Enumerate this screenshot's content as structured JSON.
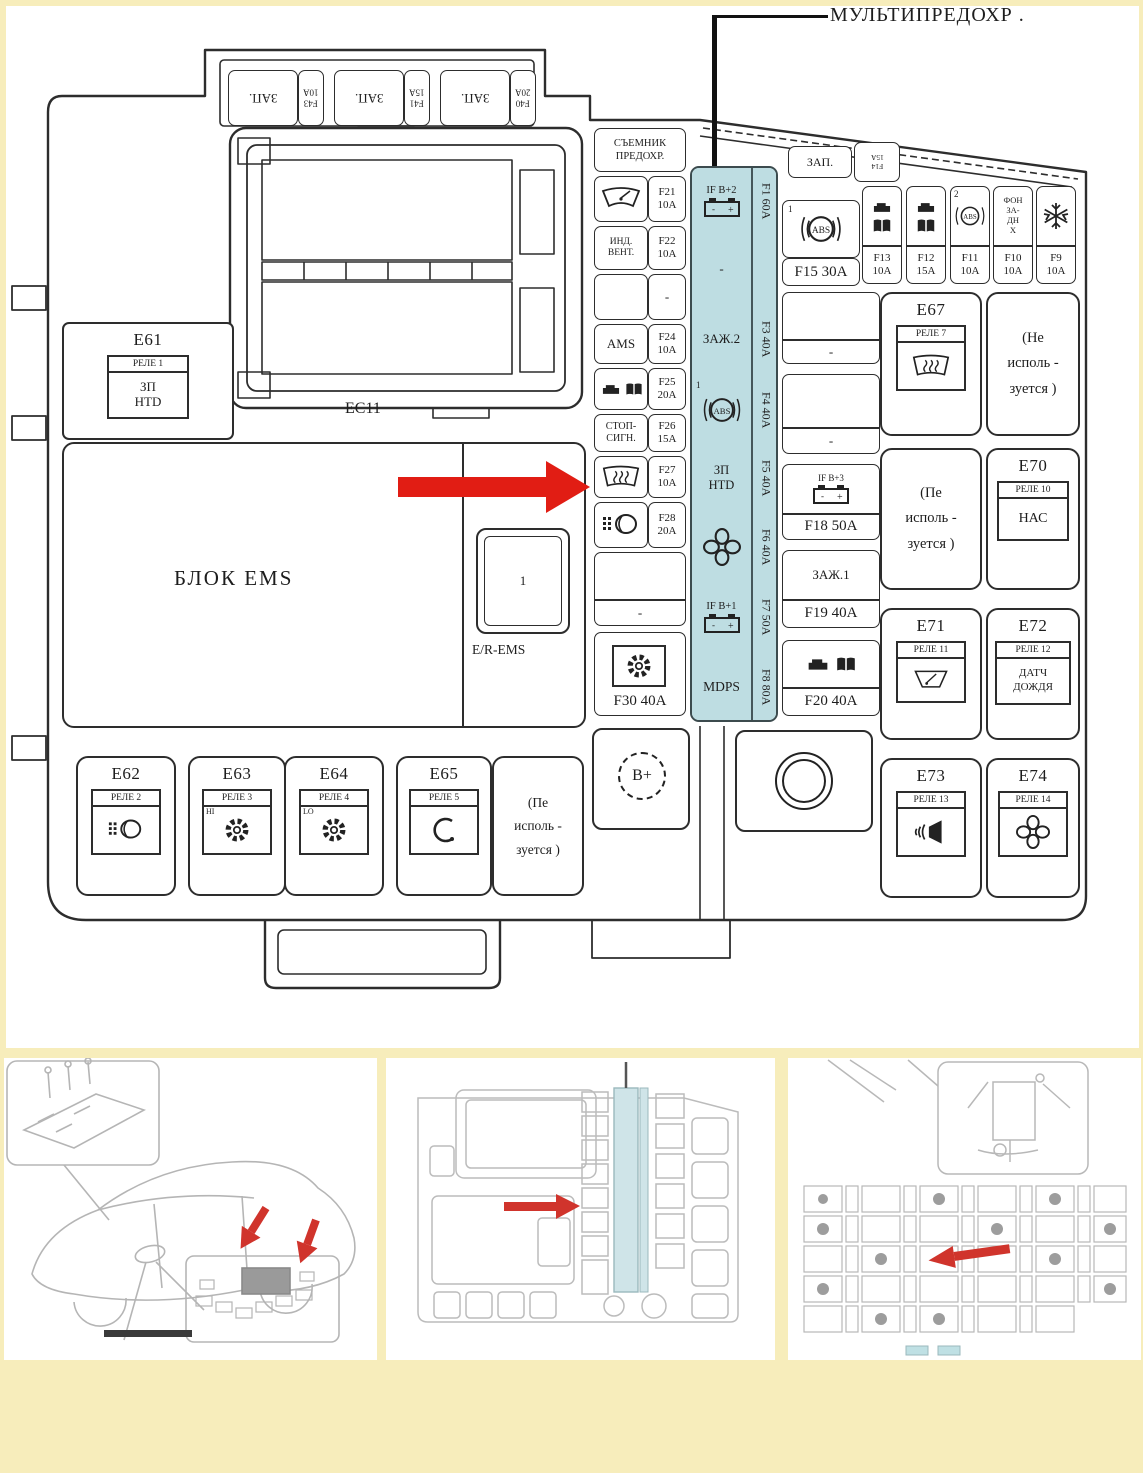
{
  "title": "МУЛЬТИПРЕДОХР .",
  "colors": {
    "background": "#f7edbb",
    "panel": "#ffffff",
    "line": "#2d2d2d",
    "multifuse_highlight": "#bedde2",
    "arrow_red": "#e11d14",
    "thumb_red": "#d0342c"
  },
  "icons": {
    "callout-arrow-icon": "black down arrow",
    "pointer-arrow-icon": "red right arrow",
    "battery-icon": "battery with - + terminals",
    "abs-icon": "((ABS)) in circle",
    "wiper-icon": "windshield wiper",
    "rear-defrost-icon": "heated rear window",
    "fan-icon": "cooling fan",
    "engine-icon": "engine block",
    "ecu-book-icon": "ecu module",
    "horn-icon": "horn speaker",
    "horn-contour-icon": "horn contour",
    "headlamp-washer-icon": "headlamp washer",
    "gear-icon": "gear",
    "snowflake-icon": "air conditioning",
    "bolt-circle-icon": "terminal stud"
  },
  "main": {
    "connector_label": "EC11",
    "bplus": "B+",
    "puller_l1": "СЪЕМНИК",
    "puller_l2": "ПРЕДОХР.",
    "top_row": [
      {
        "zap": "ЗАП.",
        "fuse_id": "F43",
        "fuse_amp": "10A"
      },
      {
        "zap": "ЗАП.",
        "fuse_id": "F41",
        "fuse_amp": "15A"
      },
      {
        "zap": "ЗАП.",
        "fuse_id": "F40",
        "fuse_amp": "20A"
      }
    ],
    "e61": {
      "id": "E61",
      "header": "РЕЛЕ 1",
      "body_l1": "ЗП",
      "body_l2": "HTD"
    },
    "ems": {
      "label": "БЛОК EMS",
      "slot": "1",
      "sub": "E/R-EMS"
    },
    "mid_fuses": [
      {
        "id": "F21",
        "amp": "10A"
      },
      {
        "label_l1": "ИНД.",
        "label_l2": "ВЕНТ.",
        "id": "F22",
        "amp": "10A"
      },
      {
        "dash": "-"
      },
      {
        "label": "AMS",
        "id": "F24",
        "amp": "10A"
      },
      {
        "id": "F25",
        "amp": "20A"
      },
      {
        "label_l1": "СТОП-",
        "label_l2": "СИГН.",
        "id": "F26",
        "amp": "15A"
      },
      {
        "id": "F27",
        "amp": "10A"
      },
      {
        "id": "F28",
        "amp": "20A"
      }
    ],
    "blank_dash": "-",
    "f30": {
      "label": "F30 40A"
    },
    "multifuse": {
      "rows": [
        {
          "label": "IF B+2",
          "strip": "F1 60A"
        },
        {
          "label": "-",
          "strip": ""
        },
        {
          "label": "ЗАЖ.2",
          "strip": "F3 40A"
        },
        {
          "sup": "1",
          "strip": "F4 40A"
        },
        {
          "label_l1": "ЗП",
          "label_l2": "HTD",
          "strip": "F5 40A"
        },
        {
          "strip": "F6 40A"
        },
        {
          "label": "IF B+1",
          "strip": "F7 50A"
        },
        {
          "label": "MDPS",
          "strip": "F8 80A"
        }
      ]
    },
    "right_top": {
      "zap": "ЗАП.",
      "zap_fuse_id": "F14",
      "zap_fuse_amp": "15A",
      "f15": {
        "sup": "1",
        "label": "F15 30A"
      },
      "fuses": [
        {
          "id": "F13",
          "amp": "10A"
        },
        {
          "id": "F12",
          "amp": "15A"
        },
        {
          "id": "F11",
          "amp": "10A",
          "sup": "2"
        },
        {
          "id": "F10",
          "amp": "10A",
          "l1": "ФОН",
          "l2": "ЗА-",
          "l3": "ДН",
          "l4": "Х"
        },
        {
          "id": "F9",
          "amp": "10A"
        }
      ]
    },
    "mid_right": {
      "b1_dash": "-",
      "b2_dash": "-",
      "b3": {
        "label": "IF B+3",
        "amp": "F18 50A"
      },
      "b4": {
        "label": "ЗАЖ.1",
        "amp": "F19 40A"
      },
      "b5": {
        "amp": "F20 40A"
      }
    },
    "relays": {
      "e67": {
        "id": "E67",
        "header": "РЕЛЕ 7"
      },
      "na_right_top": {
        "l1": "(Не",
        "l2": "исполь -",
        "l3": "зуется )"
      },
      "na_mid": {
        "l1": "(Пе",
        "l2": "исполь -",
        "l3": "зуется )"
      },
      "e70": {
        "id": "E70",
        "header": "РЕЛЕ 10",
        "body": "НАС"
      },
      "e71": {
        "id": "E71",
        "header": "РЕЛЕ 11"
      },
      "e72": {
        "id": "E72",
        "header": "РЕЛЕ 12",
        "body_l1": "ДАТЧ",
        "body_l2": "ДОЖДЯ"
      },
      "e73": {
        "id": "E73",
        "header": "РЕЛЕ 13"
      },
      "e74": {
        "id": "E74",
        "header": "РЕЛЕ 14"
      },
      "e62": {
        "id": "E62",
        "header": "РЕЛЕ 2"
      },
      "e63": {
        "id": "E63",
        "header": "РЕЛЕ 3",
        "tag": "HI"
      },
      "e64": {
        "id": "E64",
        "header": "РЕЛЕ 4",
        "tag": "LO"
      },
      "e65": {
        "id": "E65",
        "header": "РЕЛЕ 5"
      },
      "na_bottom": {
        "l1": "(Пе",
        "l2": "исполь -",
        "l3": "зуется )"
      }
    }
  },
  "thumbnails": {
    "left": "car-location-sketch",
    "middle": "engine-fusebox-mini",
    "right": "interior-fusebox-mini"
  }
}
